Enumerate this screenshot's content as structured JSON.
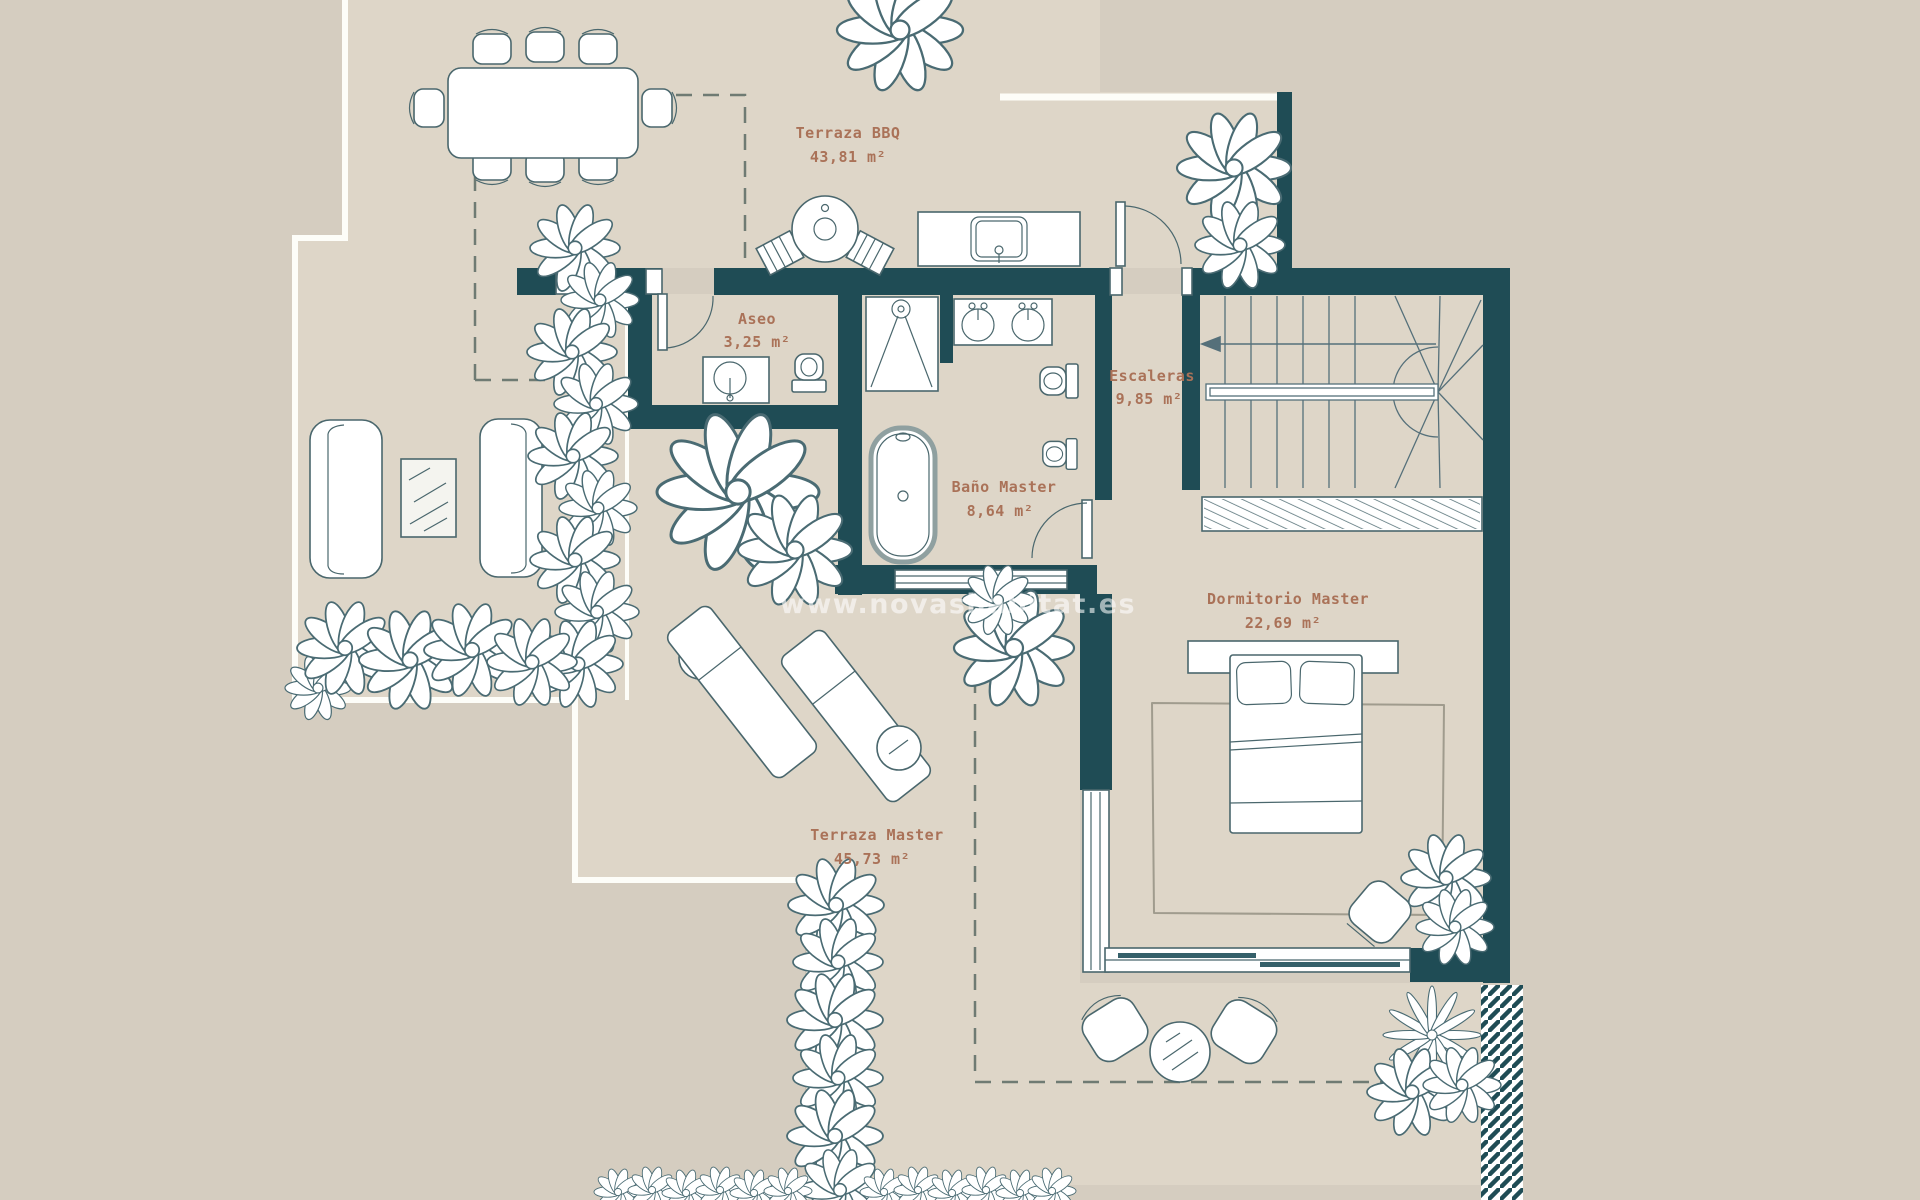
{
  "title": "Floor plan - penthouse upper level",
  "watermark": {
    "text": "www.novashabitat.es"
  },
  "rooms": {
    "terraza_bbq": {
      "name": "Terraza BBQ",
      "area": "43,81 m²"
    },
    "aseo": {
      "name": "Aseo",
      "area": "3,25 m²"
    },
    "escaleras": {
      "name": "Escaleras",
      "area": "9,85 m²"
    },
    "bano_master": {
      "name": "Baño Master",
      "area": "8,64 m²"
    },
    "dormitorio_master": {
      "name": "Dormitorio Master",
      "area": "22,69 m²"
    },
    "terraza_master": {
      "name": "Terraza Master",
      "area": "45,73 m²"
    }
  },
  "colors": {
    "background": "#d5cdc0",
    "floor": "#ded6c8",
    "wall": "#1f4c55",
    "label": "#aa7258",
    "line": "#4a676d",
    "watermark": "#ffffff"
  }
}
